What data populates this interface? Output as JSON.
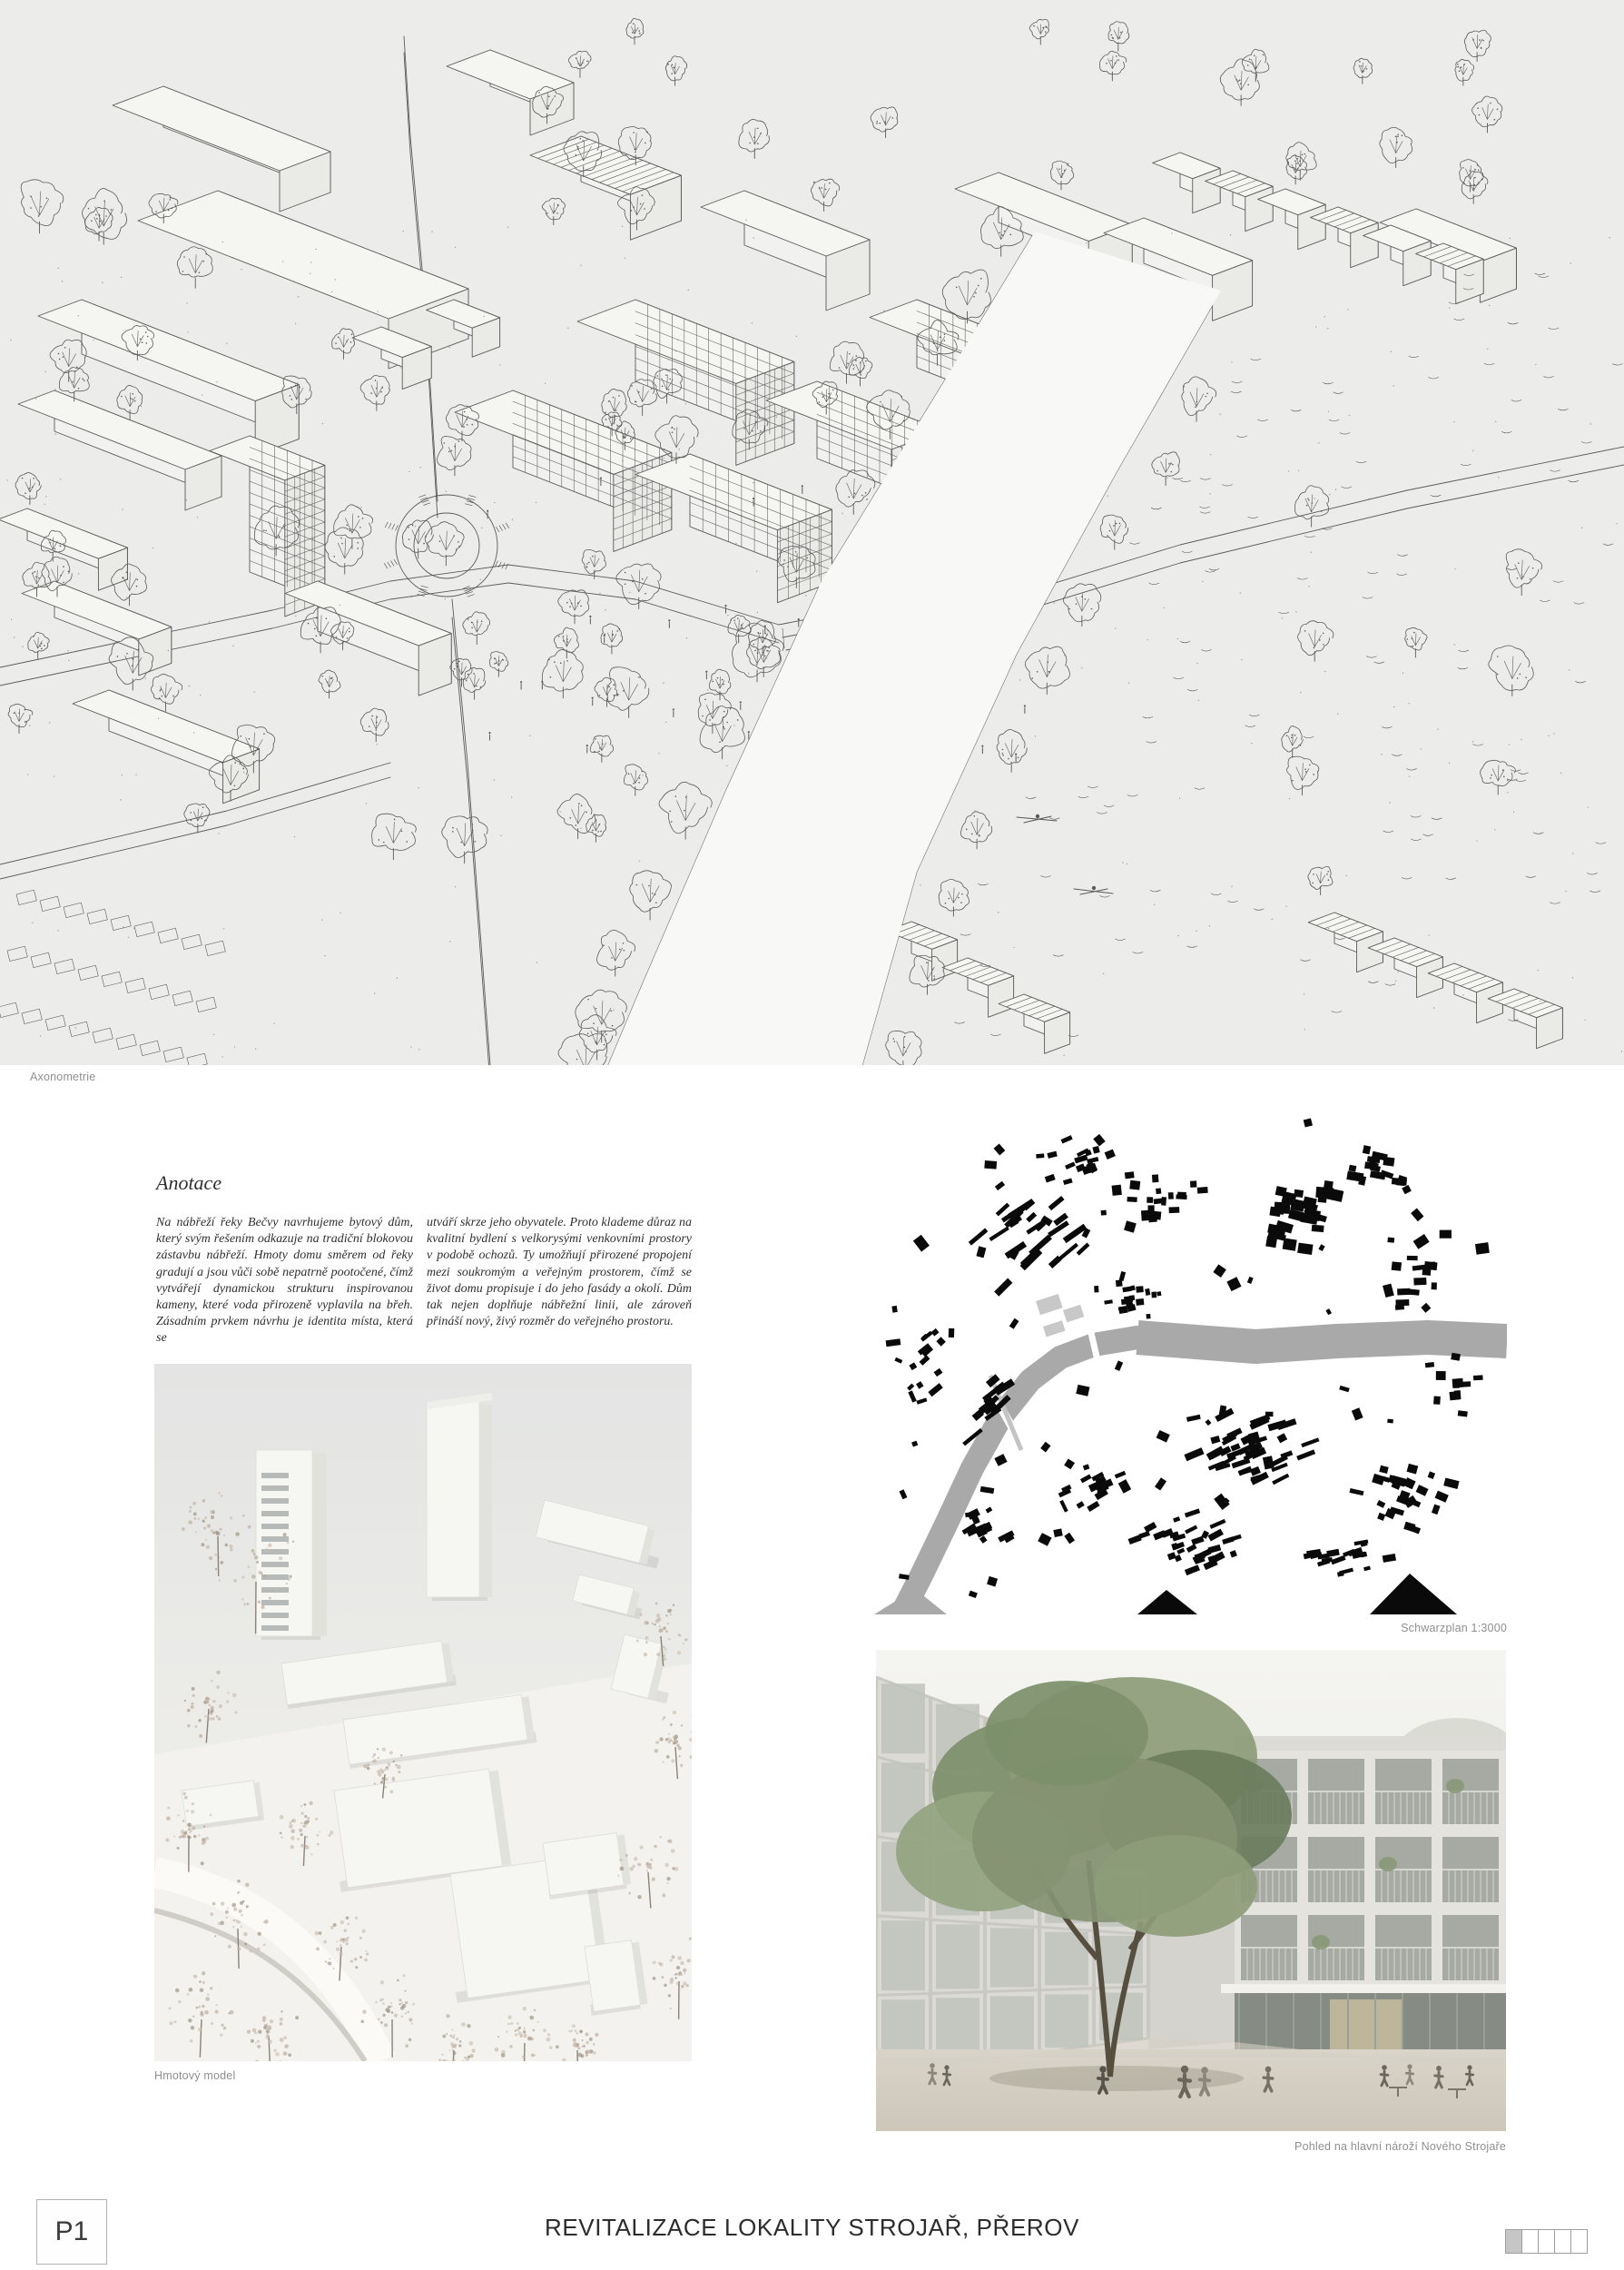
{
  "panel": {
    "id_label": "P1",
    "title": "REVITALIZACE LOKALITY STROJAŘ, PŘEROV"
  },
  "captions": {
    "axonometrie": "Axonometrie",
    "schwarzplan": "Schwarzplan 1:3000",
    "model": "Hmotový model",
    "render": "Pohled na hlavní nároží Nového Strojaře"
  },
  "annotation": {
    "heading": "Anotace",
    "col1": "Na nábřeží řeky Bečvy navrhujeme bytový dům, který svým řešením odkazuje na tradiční blokovou zástavbu nábřeží. Hmoty domu směrem od řeky gradují a jsou vůči sobě nepatrně pootočené, čímž vytvářejí dynamickou strukturu inspirovanou kameny, které voda přirozeně vyplavila na břeh. Zásadním prvkem návrhu je identita místa, která se",
    "col2": "utváří skrze jeho obyvatele. Proto klademe důraz na kvalitní bydlení s velkorysými venkovními prostory v podobě ochozů. Ty umožňují přirozené propojení mezi soukromým a veřejným prostorem, čímž se život domu propisuje i do jeho fasády a okolí. Dům tak nejen doplňuje nábřežní linii, ale zároveň přináší nový, živý rozměr do veřejného prostoru."
  },
  "pagination": {
    "cells": 5,
    "active_index": 0
  },
  "colors": {
    "axo_bg": "#ecedeb",
    "line": "#3c3c3c",
    "river_gray": "#a9a9a9",
    "site_gray": "#c8c8c8",
    "caption_gray": "#8f8f8f",
    "ink": "#2c2c2c"
  }
}
